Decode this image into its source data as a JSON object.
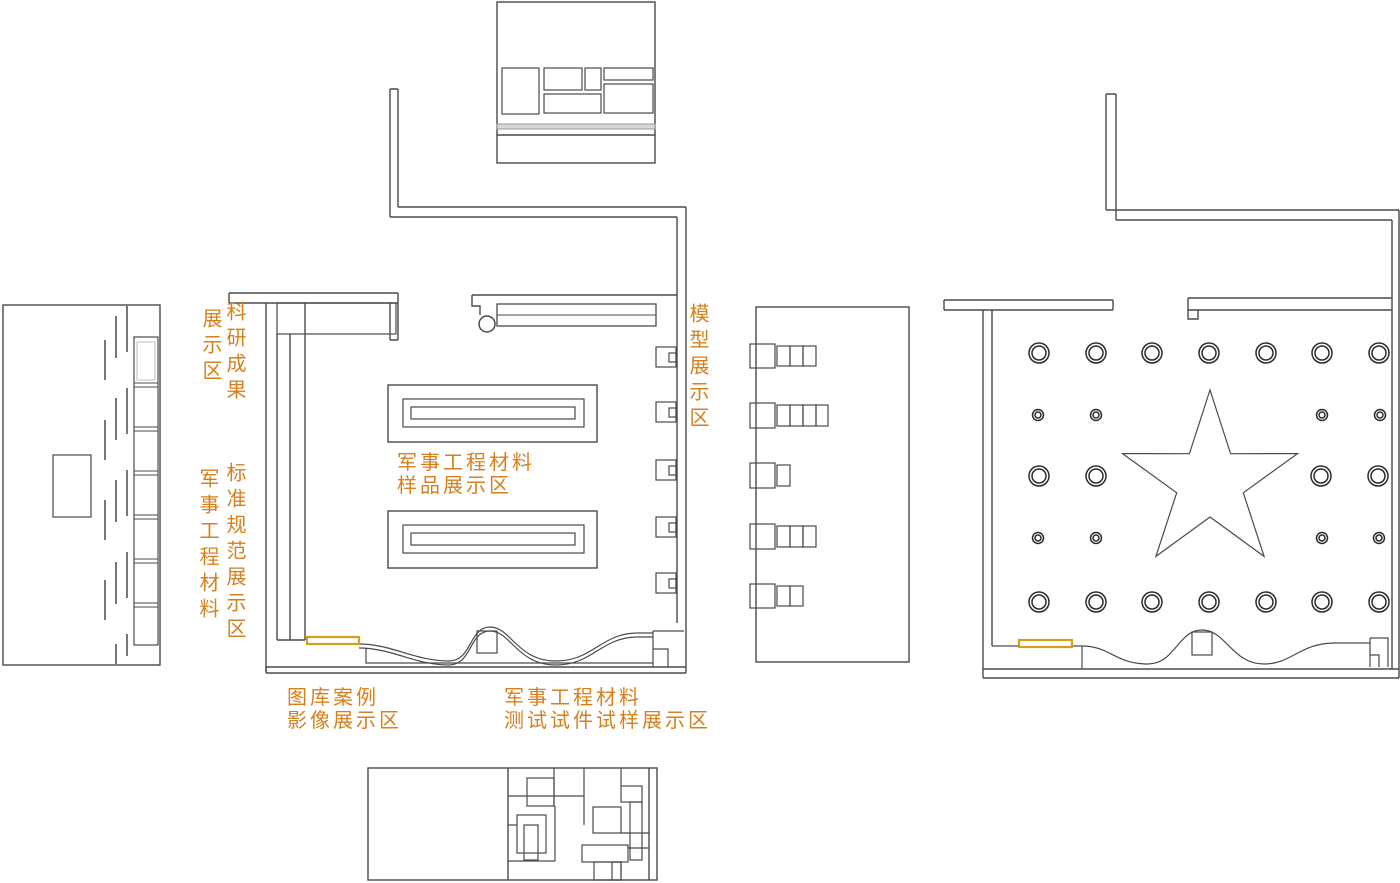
{
  "document": {
    "type": "exhibition-hall-floor-plan-drawing",
    "background": "#ffffff"
  },
  "colors": {
    "wall_line": "#4a4a4a",
    "light_line": "#9a9a9a",
    "label_text": "#d6801c",
    "highlight_strip": "#d4a017"
  },
  "labels": {
    "research_display": {
      "column1": "科研成果",
      "column2": "展示区"
    },
    "materials_standards": {
      "column1": "标准规范展示区",
      "column2": "军事工程材料"
    },
    "model_display": {
      "text": "模型展示区"
    },
    "samples_display": {
      "line1": "军事工程材料",
      "line2": "样品展示区"
    },
    "gallery_display": {
      "line1": "图库案例",
      "line2": "影像展示区"
    },
    "test_specimen_display": {
      "line1": "军事工程材料",
      "line2": "测试试件试样展示区"
    }
  }
}
